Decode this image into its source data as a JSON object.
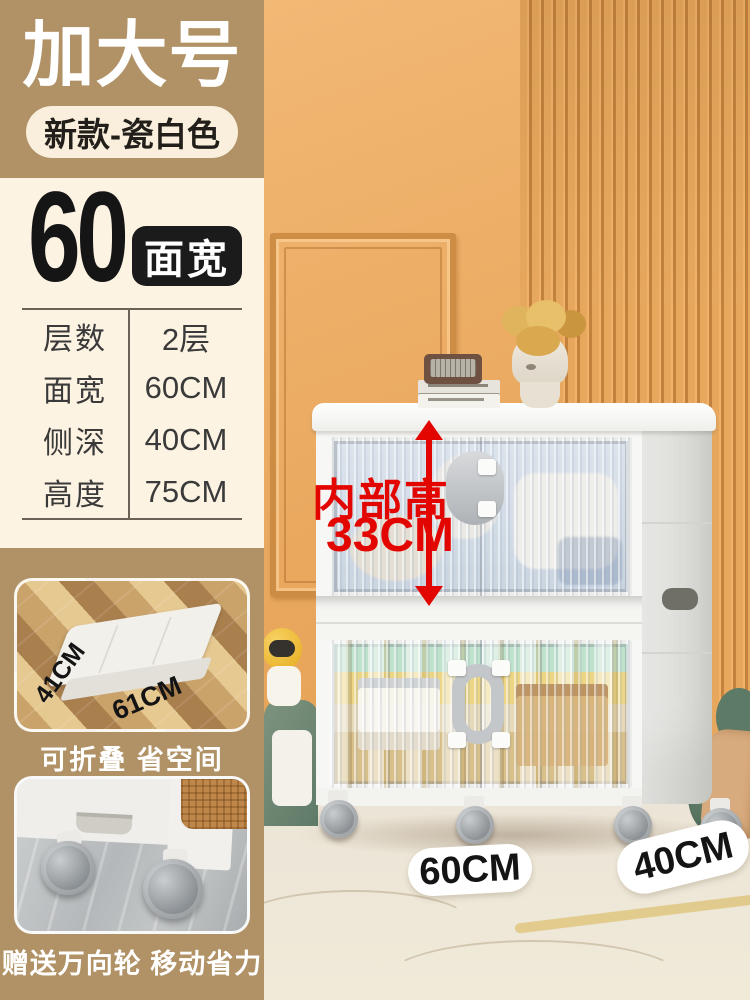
{
  "header": {
    "title": "加大号",
    "variant_badge": "新款-瓷白色"
  },
  "size_block": {
    "number": "60",
    "unit_badge": "面宽"
  },
  "spec_table": {
    "rows": [
      {
        "label": "层数",
        "value": "2层"
      },
      {
        "label": "面宽",
        "value": "60CM"
      },
      {
        "label": "侧深",
        "value": "40CM"
      },
      {
        "label": "高度",
        "value": "75CM"
      }
    ]
  },
  "photo_annotations": {
    "inner_height_title": "内部高",
    "inner_height_value": "33CM",
    "front_width": "60CM",
    "side_depth": "40CM"
  },
  "feature_fold": {
    "depth_label": "41CM",
    "width_label": "61CM",
    "caption": "可折叠 省空间"
  },
  "feature_wheels": {
    "caption": "赠送万向轮 移动省力"
  },
  "colors": {
    "brand_tan": "#b19266",
    "cream": "#fdf3e3",
    "badge_black": "#1b1b1b",
    "accent_red": "#e30500",
    "wall_orange": "#e8a75d"
  }
}
